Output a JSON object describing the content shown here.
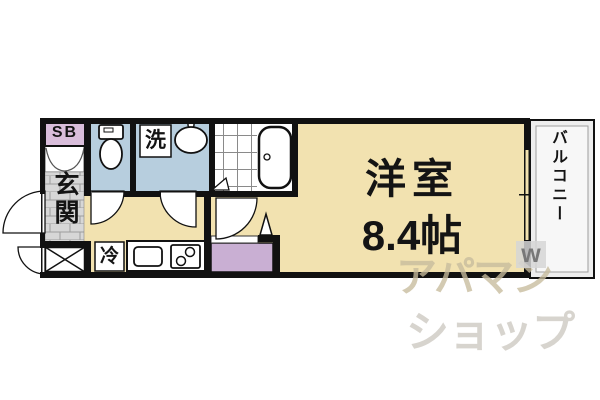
{
  "plan": {
    "main_room": {
      "name": "洋室",
      "size": "8.4帖"
    },
    "entrance_label": "玄関",
    "balcony_label": "バルコニー",
    "shoebox_label": "SB",
    "washer_label": "洗",
    "fridge_label": "冷"
  },
  "watermark": {
    "line1": "アパマン",
    "line2": "ショップ",
    "logo": "w"
  },
  "colors": {
    "floor": "#f2e2b0",
    "wet_rooms": "#b7cede",
    "entrance_tile": "#d7d7d7",
    "shoebox": "#d9bedb",
    "storage": "#c9afd3",
    "balcony": "#ededed",
    "wall": "#111111"
  }
}
